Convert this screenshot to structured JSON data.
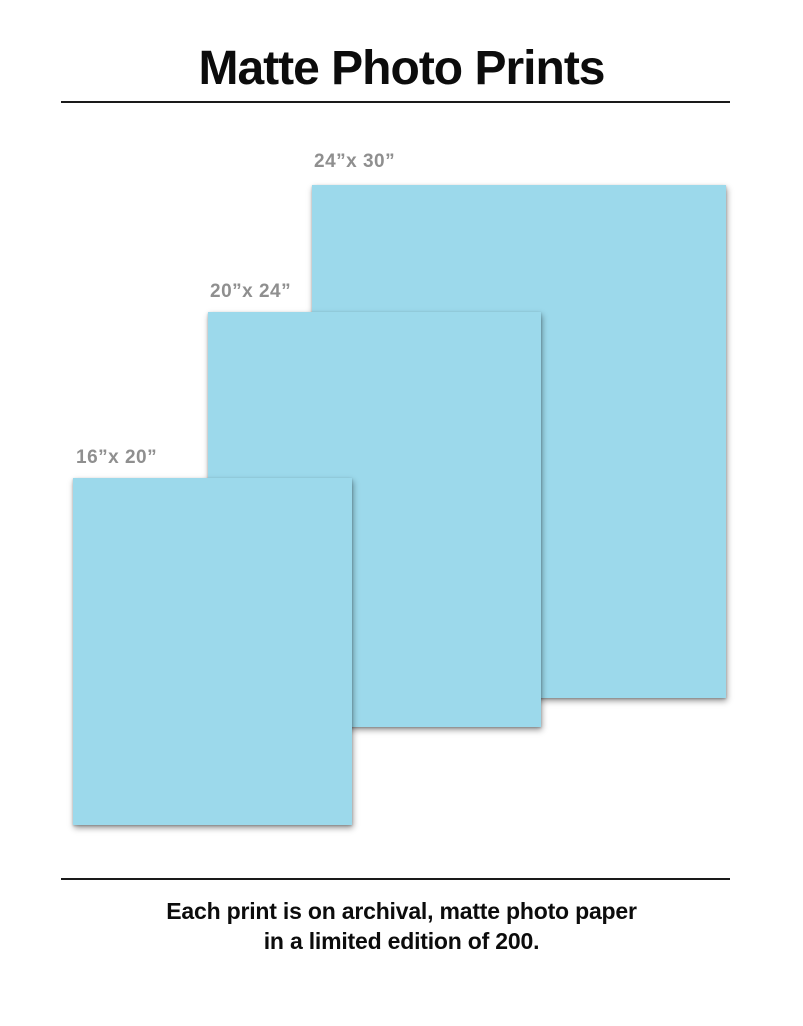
{
  "title": "Matte Photo Prints",
  "prints": [
    {
      "id": "24x30",
      "label": "24”x 30”",
      "width_inches": 24,
      "height_inches": 30
    },
    {
      "id": "20x24",
      "label": "20”x 24”",
      "width_inches": 20,
      "height_inches": 24
    },
    {
      "id": "16x20",
      "label": "16”x 20”",
      "width_inches": 16,
      "height_inches": 20
    }
  ],
  "caption": {
    "line1": "Each print is on archival, matte photo paper",
    "line2": "in a limited edition of 200."
  },
  "colors": {
    "print_fill": "#9cd9eb",
    "label_text": "#8f8f8f",
    "text": "#0c0c0c",
    "rule": "#1a1a1a"
  }
}
